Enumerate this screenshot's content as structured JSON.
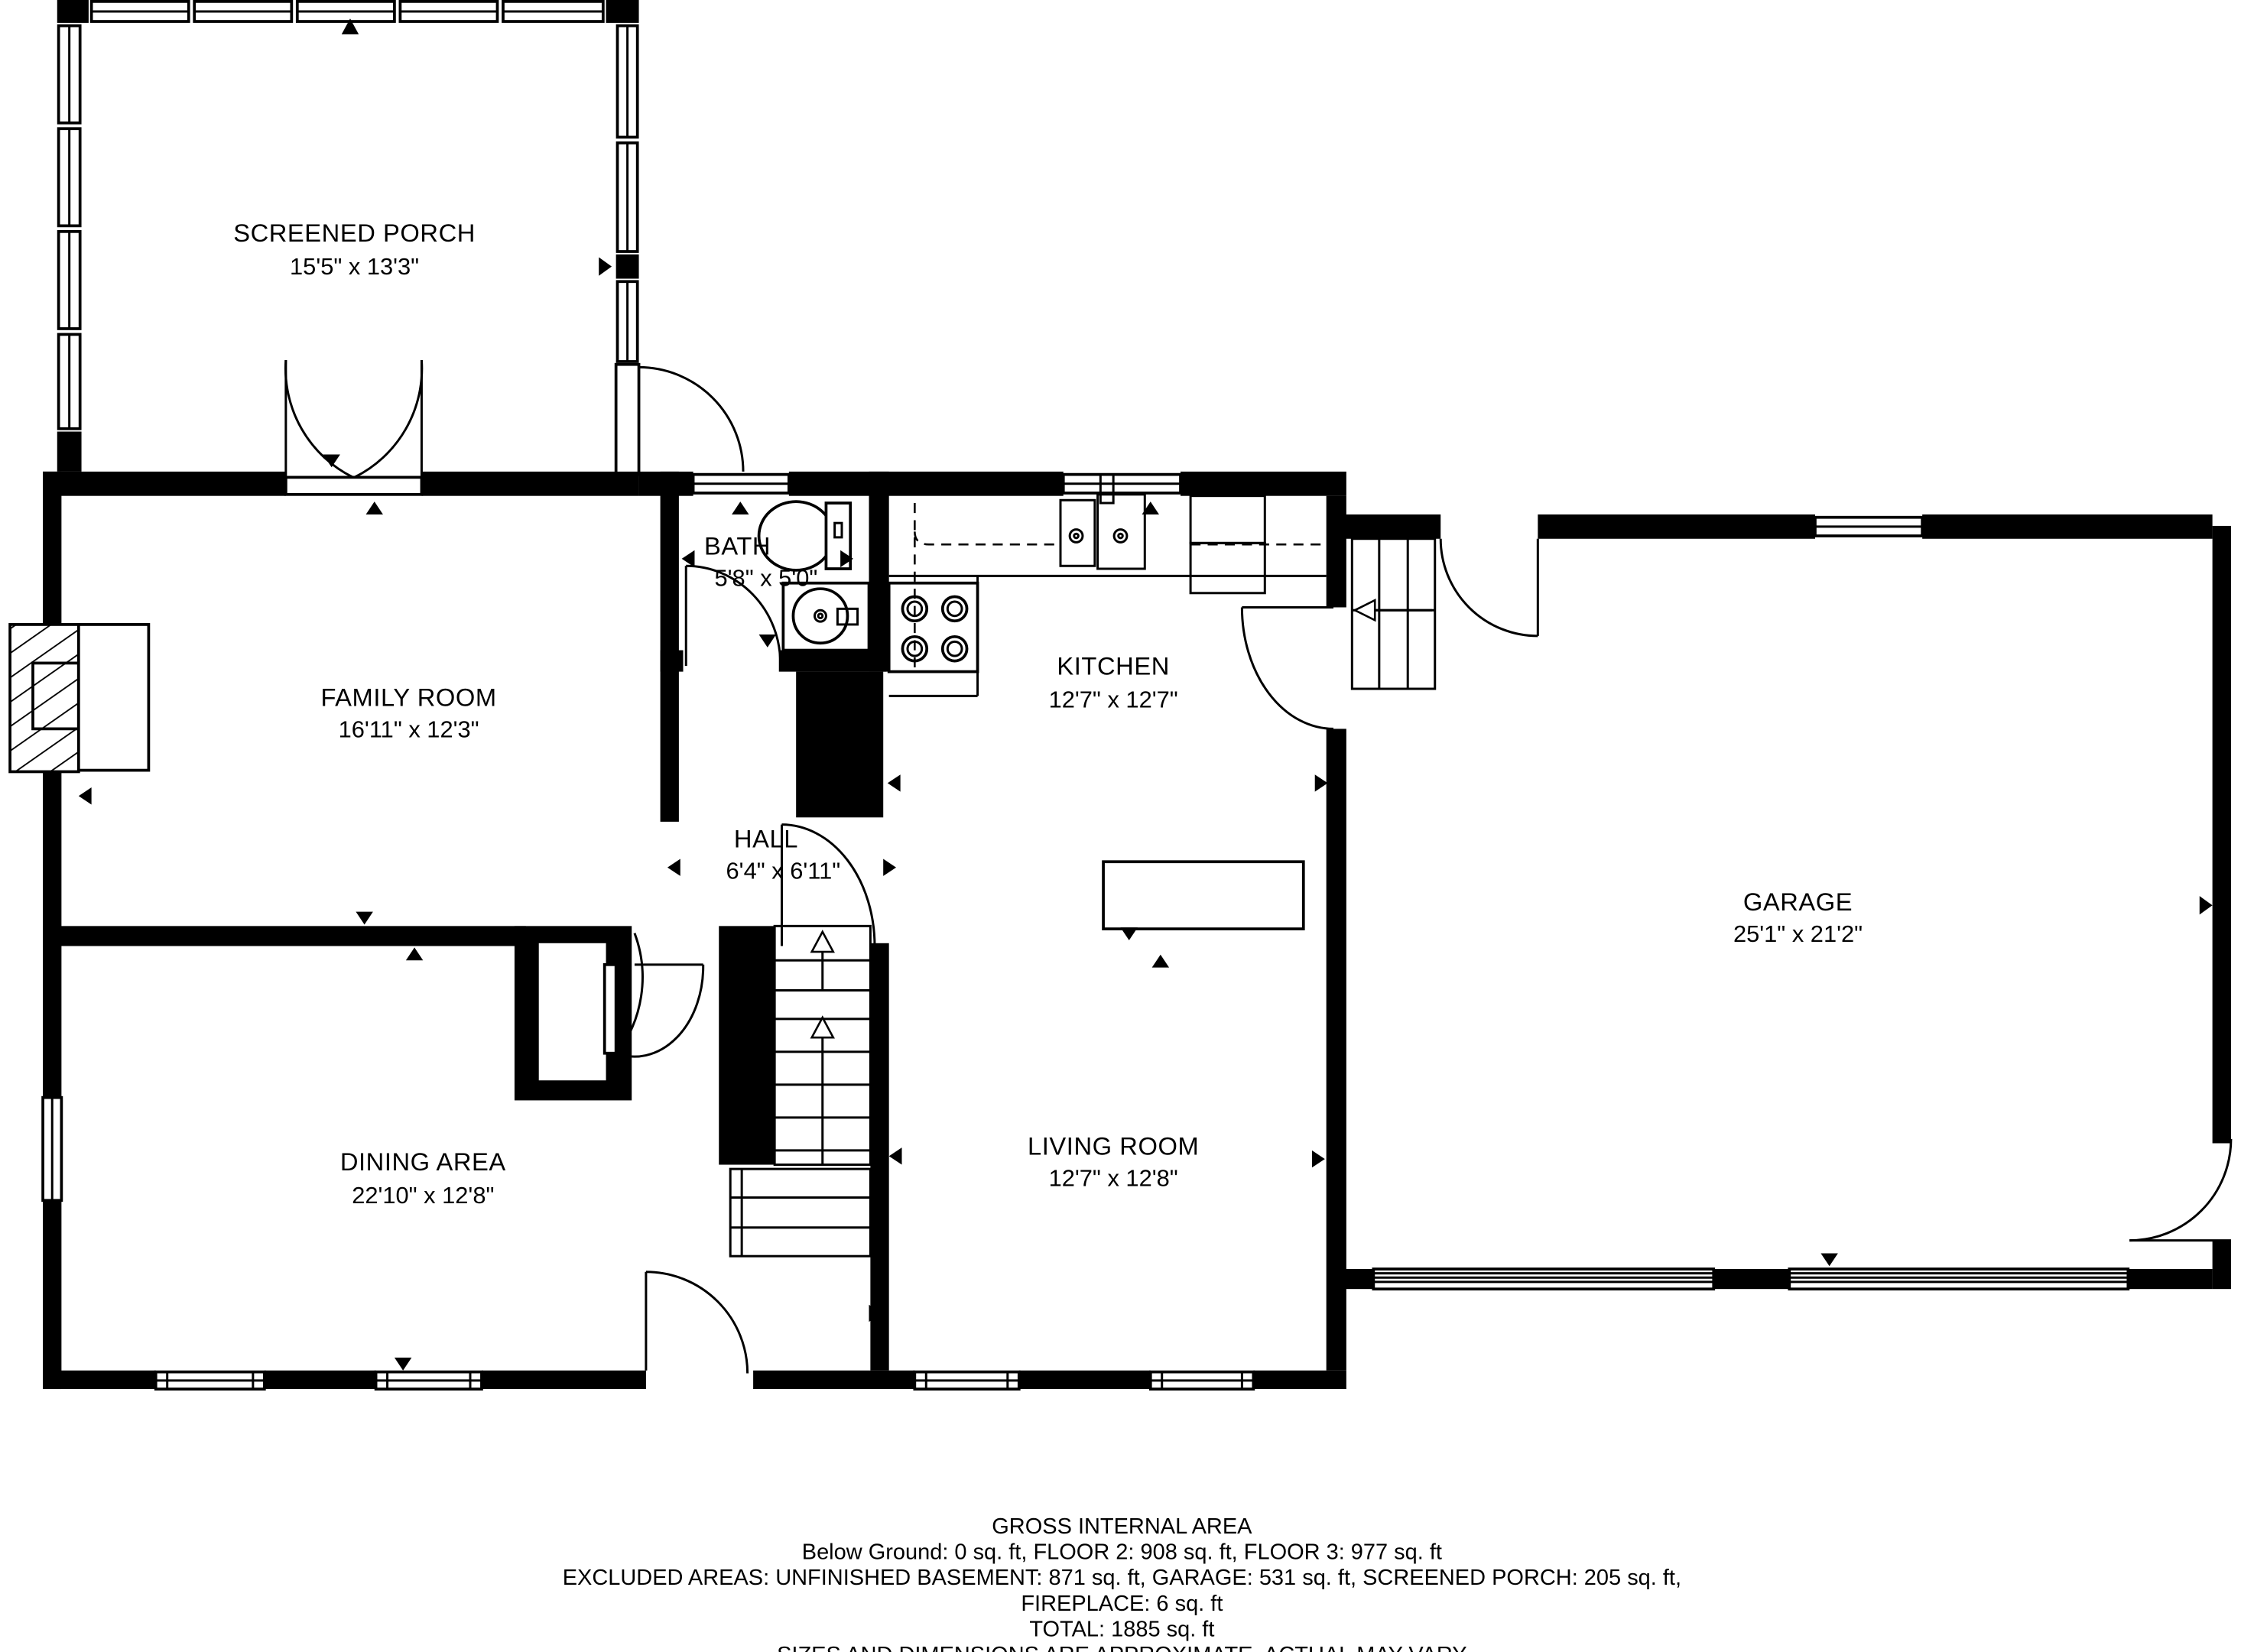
{
  "plan_title": "First floor plan",
  "rooms": [
    {
      "name": "SCREENED PORCH",
      "dims": "15'5\" x 13'3\""
    },
    {
      "name": "FAMILY ROOM",
      "dims": "16'11\" x 12'3\""
    },
    {
      "name": "BATH",
      "dims": "5'8\" x 5'0\""
    },
    {
      "name": "KITCHEN",
      "dims": "12'7\" x 12'7\""
    },
    {
      "name": "HALL",
      "dims": "6'4\" x 6'11\""
    },
    {
      "name": "GARAGE",
      "dims": "25'1\" x 21'2\""
    },
    {
      "name": "DINING AREA",
      "dims": "22'10\" x 12'8\""
    },
    {
      "name": "LIVING ROOM",
      "dims": "12'7\" x 12'8\""
    }
  ],
  "footer": {
    "title": "GROSS INTERNAL AREA",
    "line1": "Below Ground: 0 sq. ft, FLOOR 2: 908 sq. ft, FLOOR 3: 977 sq. ft",
    "line2": "EXCLUDED AREAS: UNFINISHED BASEMENT: 871 sq. ft, GARAGE: 531 sq. ft, SCREENED PORCH: 205 sq. ft,",
    "line3": "FIREPLACE: 6 sq. ft",
    "line4": "TOTAL: 1885 sq. ft",
    "disclaimer": "SIZES AND DIMENSIONS ARE APPROXIMATE, ACTUAL MAY VARY"
  },
  "colors": {
    "wall": "#000000",
    "background": "#ffffff"
  }
}
